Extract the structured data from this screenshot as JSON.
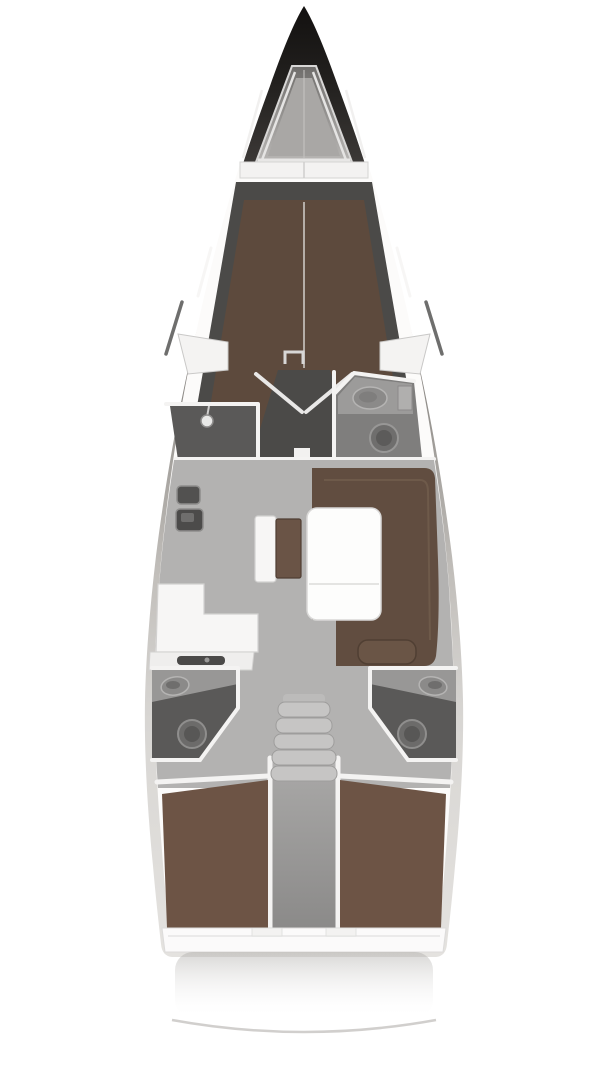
{
  "diagram": {
    "type": "sailing-yacht-interior-floor-plan",
    "orientation": "bow-at-top",
    "render_style": "top-down 3D render, no text labels",
    "regions": {
      "bow": [
        "anchor-locker"
      ],
      "forward_cabin": [
        "v-berth-double",
        "side-shelf-port",
        "side-shelf-starboard",
        "wardrobe-double-doors"
      ],
      "forward_wet_rooms": [
        "shower-room-port",
        "head-starboard-with-sink-and-toilet"
      ],
      "salon": [
        "u-shaped-settee-starboard",
        "folding-table",
        "bench-seat",
        "galley-port-with-stove-and-sinks"
      ],
      "midship": [
        "companionway-stairs"
      ],
      "aft": [
        "head-port",
        "head-starboard",
        "aft-cabin-port-double-berth",
        "aft-cabin-starboard-double-berth",
        "engine-compartment"
      ],
      "stern": [
        "transom-deck",
        "swim-platform-edge"
      ]
    },
    "fixtures": {
      "toilets": 3,
      "sinks": 4,
      "shower_heads": 1,
      "berths": 3,
      "stair_steps": 5
    }
  },
  "colors": {
    "hull_dark": "#141210",
    "hull_mid": "#807d79",
    "deck_white": "#fcfbfa",
    "wall_white": "#f4f3f2",
    "floor_gray": "#b3b2b1",
    "cabin_floor_dark": "#4b4a48",
    "berth_brown": "#5d4a3d",
    "settee_brown": "#614d40",
    "settee_cushion_brown": "#6a5546",
    "aft_berth_brown": "#6d5445",
    "wet_room_gray": "#5a5958",
    "fixture_gray": "#8b8a89",
    "table_white": "#fdfdfc",
    "shadow_gray": "#c9c7c4"
  }
}
